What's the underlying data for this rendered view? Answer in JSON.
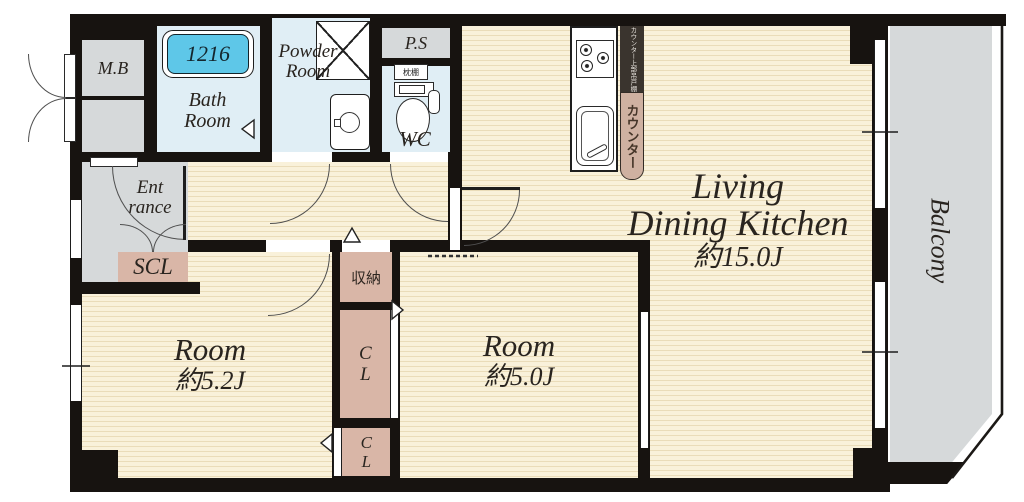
{
  "floorplan": {
    "units": {
      "mb": {
        "label": "M.B"
      },
      "bath": {
        "l1": "Bath",
        "l2": "Room",
        "tub": "1216"
      },
      "powder": {
        "l1": "Powder",
        "l2": "Room"
      },
      "ps": {
        "label": "P.S"
      },
      "wc": {
        "label": "WC",
        "shelf": "枕棚"
      },
      "kitchen": {
        "counter": "カウンター",
        "cabinet": "カウンター上部吊戸棚"
      },
      "ldk": {
        "l1": "Living",
        "l2": "Dining Kitchen",
        "size": "約15.0J"
      },
      "balcony": {
        "label": "Balcony"
      },
      "entrance": {
        "l1": "Ent",
        "l2": "rance"
      },
      "scl": {
        "label": "SCL"
      },
      "room_a": {
        "name": "Room",
        "size": "約5.2J"
      },
      "room_b": {
        "name": "Room",
        "size": "約5.0J"
      },
      "storage": {
        "label": "収納"
      },
      "closet_a": {
        "label": "CL"
      },
      "closet_b": {
        "label": "CL"
      }
    },
    "colors": {
      "wall": "#171310",
      "floor": "#f9f1da",
      "floor_stripe": "#eadcb9",
      "wet_area": "#e0eef5",
      "bathtub": "#5ec7e8",
      "gray_area": "#d6d9da",
      "closet": "#d9b6a7",
      "counter": "#cfb1a1"
    },
    "icons": [
      "bathtub",
      "washing-machine",
      "vanity-sink",
      "toilet",
      "gas-stove",
      "kitchen-sink",
      "door-swing-arc",
      "sliding-window",
      "entry-double-door",
      "closet-double-door"
    ]
  }
}
